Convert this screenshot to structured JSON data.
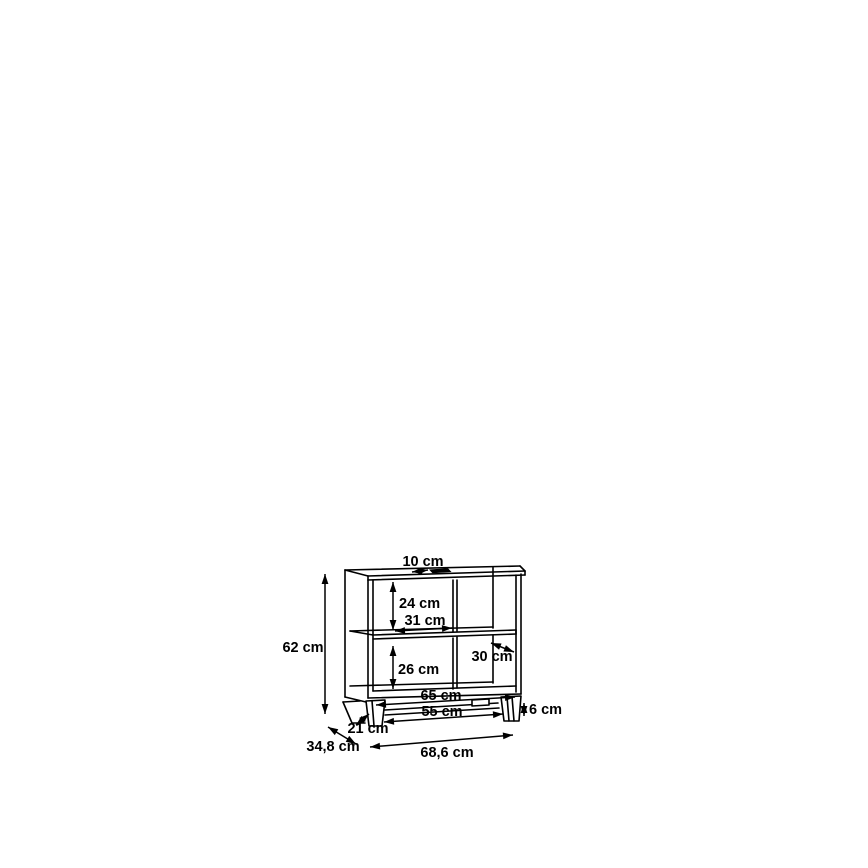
{
  "diagram": {
    "title": "Dimension drawing of a two-compartment sideboard with middle shelf, center divider and plinth feet",
    "unit": "cm",
    "background": "#ffffff",
    "line_color": "#000000",
    "overall": {
      "width_label": "68,6 cm",
      "depth_label": "34,8 cm",
      "height_label": "62 cm"
    },
    "dimensions": [
      {
        "id": "top-slot-width",
        "label": "10 cm",
        "text": {
          "x": 423,
          "y": 566,
          "anchor": "middle"
        },
        "arrow": {
          "x1": 412,
          "y1": 572,
          "x2": 428,
          "y2": 570
        }
      },
      {
        "id": "upper-compartment-height",
        "label": "24 cm",
        "text": {
          "x": 399,
          "y": 608,
          "anchor": "start"
        },
        "arrow": {
          "x1": 393,
          "y1": 582,
          "x2": 393,
          "y2": 630
        }
      },
      {
        "id": "compartment-width",
        "label": "31 cm",
        "text": {
          "x": 425,
          "y": 625,
          "anchor": "middle"
        },
        "arrow": {
          "x1": 395,
          "y1": 631,
          "x2": 452,
          "y2": 628
        }
      },
      {
        "id": "overall-height",
        "label": "62 cm",
        "text": {
          "x": 303,
          "y": 652,
          "anchor": "middle"
        },
        "arrow": {
          "x1": 325,
          "y1": 574,
          "x2": 325,
          "y2": 714
        }
      },
      {
        "id": "lower-compartment-height",
        "label": "26 cm",
        "text": {
          "x": 398,
          "y": 674,
          "anchor": "start"
        },
        "arrow": {
          "x1": 393,
          "y1": 646,
          "x2": 393,
          "y2": 689
        }
      },
      {
        "id": "interior-depth",
        "label": "30 cm",
        "text": {
          "x": 492,
          "y": 661,
          "anchor": "middle"
        },
        "arrow": {
          "x1": 491,
          "y1": 643,
          "x2": 514,
          "y2": 652
        }
      },
      {
        "id": "interior-width",
        "label": "65 cm",
        "text": {
          "x": 441,
          "y": 700,
          "anchor": "middle"
        },
        "arrow": {
          "x1": 376,
          "y1": 705,
          "x2": 515,
          "y2": 697
        }
      },
      {
        "id": "plinth-width",
        "label": "55 cm",
        "text": {
          "x": 442,
          "y": 716,
          "anchor": "middle"
        },
        "arrow": {
          "x1": 384,
          "y1": 722,
          "x2": 503,
          "y2": 714
        }
      },
      {
        "id": "foot-height",
        "label": "6 cm",
        "text": {
          "x": 529,
          "y": 714,
          "anchor": "start"
        },
        "arrow": {
          "x1": 524,
          "y1": 703,
          "x2": 524,
          "y2": 716
        }
      },
      {
        "id": "foot-depth",
        "label": "21 cm",
        "text": {
          "x": 368,
          "y": 733,
          "anchor": "middle"
        },
        "arrow": {
          "x1": 356,
          "y1": 725,
          "x2": 369,
          "y2": 714
        }
      },
      {
        "id": "overall-depth",
        "label": "34,8 cm",
        "text": {
          "x": 333,
          "y": 751,
          "anchor": "middle"
        },
        "arrow": {
          "x1": 328,
          "y1": 727,
          "x2": 356,
          "y2": 744
        }
      },
      {
        "id": "overall-width",
        "label": "68,6 cm",
        "text": {
          "x": 447,
          "y": 757,
          "anchor": "middle"
        },
        "arrow": {
          "x1": 370,
          "y1": 747,
          "x2": 513,
          "y2": 735
        }
      }
    ]
  }
}
